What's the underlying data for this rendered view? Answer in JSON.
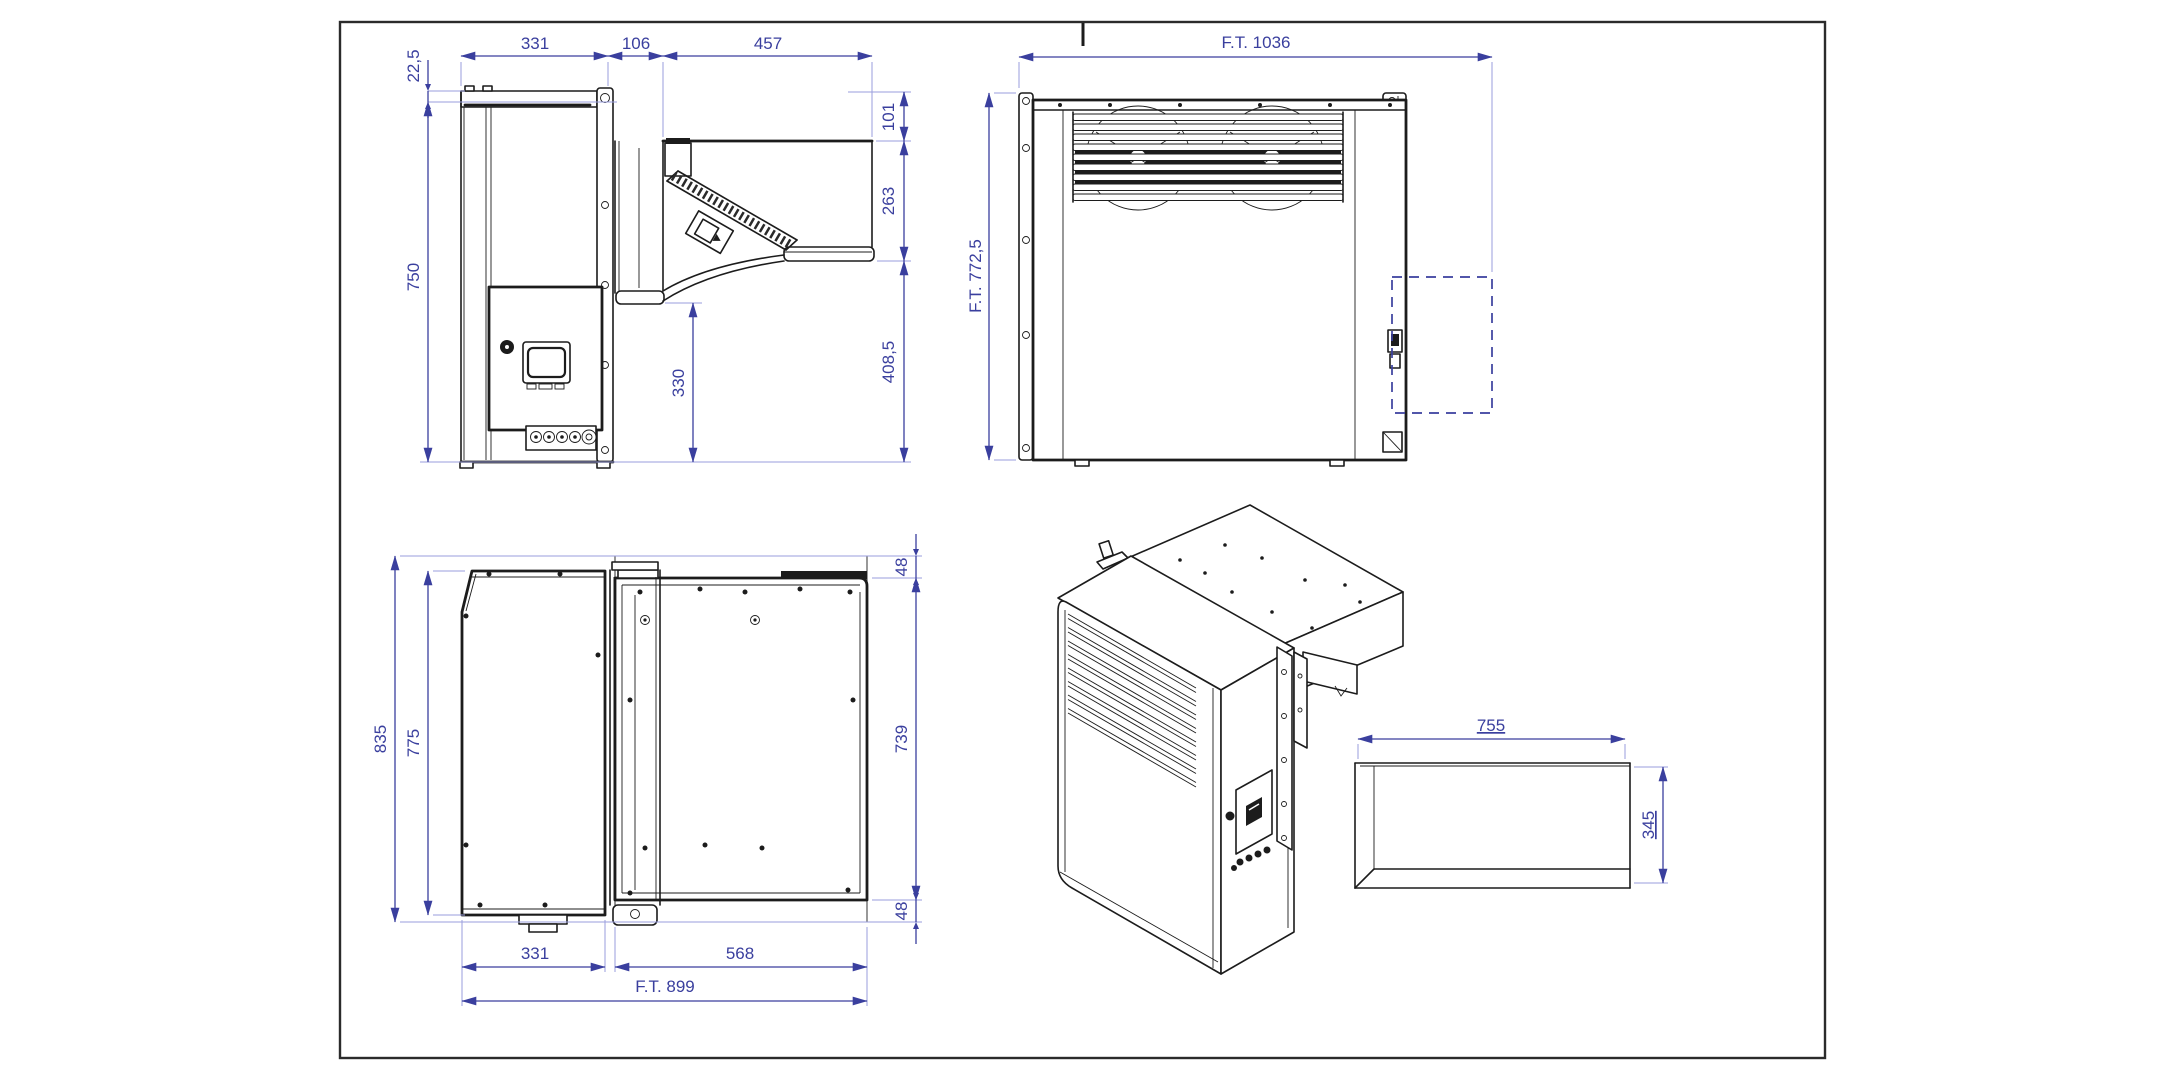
{
  "colors": {
    "dimension_text": "#3a3f9e",
    "dimension_line": "#3a3f9e",
    "extension_line": "#9a9edd",
    "geometry_line": "#1c1c1c",
    "frame": "#2b2b2b",
    "dashed_outline": "#3a3f9e",
    "background": "#ffffff"
  },
  "views": {
    "side": {
      "dims": {
        "panel_offset": "22,5",
        "inner_width": "331",
        "wall_thickness": "106",
        "outer_width": "457",
        "inner_height": "750",
        "top_height": "101",
        "mid_height": "263",
        "lower_height": "408,5",
        "wall_bottom_height": "330"
      }
    },
    "front": {
      "dims": {
        "overall_width": "F.T. 1036",
        "overall_height": "F.T. 772,5"
      }
    },
    "plan": {
      "dims": {
        "overall_depth": "835",
        "inner_depth": "775",
        "top_flange": "48",
        "body_depth": "739",
        "bottom_flange": "48",
        "inner_width": "331",
        "outer_width": "568",
        "overall_width": "F.T. 899"
      }
    },
    "iso": {
      "opening": {
        "width": "755",
        "height": "345"
      }
    }
  }
}
